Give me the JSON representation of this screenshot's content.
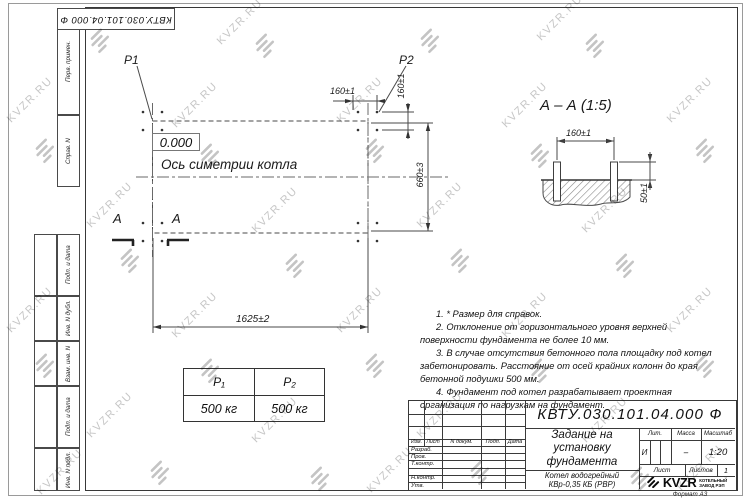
{
  "watermark": {
    "text": "KVZR.RU"
  },
  "top_stamp": {
    "doc_number": "КВТУ.030.101.04.000  Ф"
  },
  "margin_labels": {
    "perv_primen": "Перв. примен.",
    "sprav_n": "Справ. N",
    "podp_data_1": "Подп. и дата",
    "inv_n_dubl": "Инв. N дубл.",
    "vzam_inv_n": "Взам. инв. N",
    "podp_data_2": "Подп. и дата",
    "inv_n_podl": "Инв. N подл."
  },
  "plan": {
    "p1_label": "P1",
    "p2_label": "P2",
    "elevation": "0.000",
    "axis_label": "Ось симетрии котла",
    "dim_top": "160±1",
    "dim_side": "160±1",
    "dim_height": "660±3",
    "dim_width": "1625±2",
    "section_letter_left": "A",
    "section_letter_right": "A"
  },
  "section_view": {
    "title": "А – А (1:5)",
    "dim_bolt_spacing": "160±1",
    "dim_protrusion": "50±1"
  },
  "load_table": {
    "col1_header": "P₁",
    "col2_header": "P₂",
    "col1_value": "500 кг",
    "col2_value": "500 кг"
  },
  "notes": [
    "1.  * Размер для справок.",
    "2.  Отклонение от горизонтального уровня верхней поверхности фундамента не более 10 мм.",
    "3.  В случае отсутствия бетонного пола площадку под котел забетонировать. Расстояние от осей крайних колонн до края бетонной подушки 500 мм.",
    "4.  Фундамент под котел разрабатывает проектная организация по нагрузкам на фундамент."
  ],
  "title_block": {
    "doc_number": "КВТУ.030.101.04.000  Ф",
    "title_line1": "Задание на",
    "title_line2": "установку",
    "title_line3": "фундамента",
    "product_line1": "Котел водогрейный",
    "product_line2": "КВр-0,35 КБ (РВР)",
    "col_izm": "Изм.",
    "col_list": "Лист",
    "col_ndoc": "N докум.",
    "col_podp": "Подп.",
    "col_data": "Дата",
    "role_razrab": "Разраб.",
    "role_prov": "Пров.",
    "role_tkontr": "Т.контр.",
    "role_nkontr": "Н.контр.",
    "role_utv": "Утв.",
    "lit_label": "Лит.",
    "lit_value": "И",
    "massa_label": "Масса",
    "massa_value": "–",
    "scale_label": "Масштаб",
    "scale_value": "1:20",
    "sheet_label": "Лист",
    "sheets_label": "Листов",
    "sheets_value": "1",
    "logo_text": "KVZR",
    "logo_sub_line1": "КОТЕЛЬНЫЙ",
    "logo_sub_line2": "ЗАВОД РЭП",
    "format_label": "Формат А3"
  }
}
